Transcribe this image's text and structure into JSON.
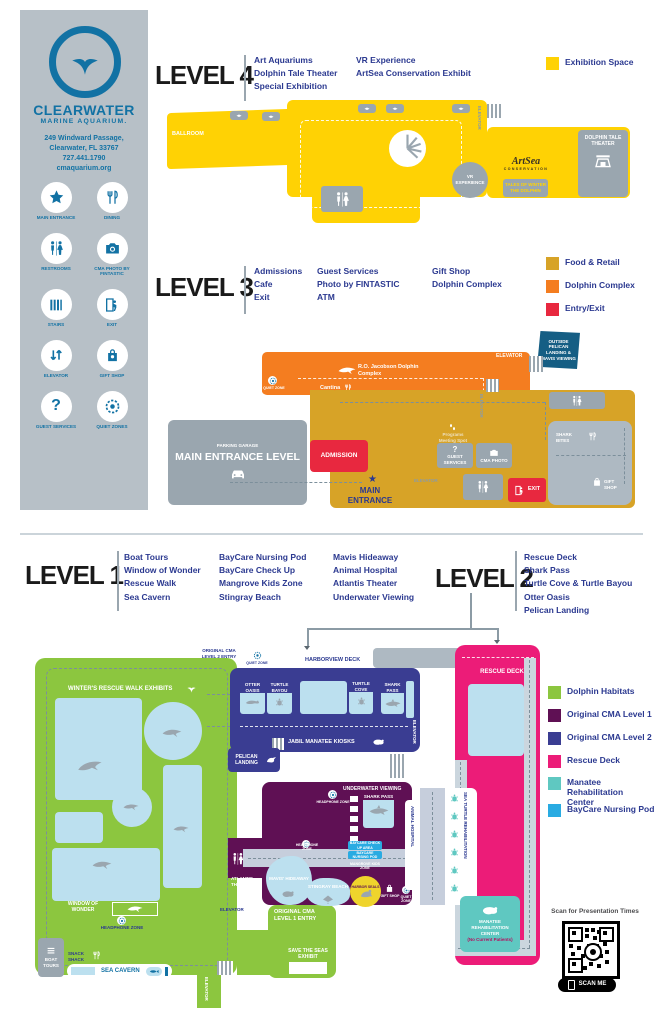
{
  "palette": {
    "sidebar_gray": "#B7C0C7",
    "cma_blue": "#1272A4",
    "navy_text": "#2B3990",
    "yellow": "#FFD204",
    "gold": "#D7A327",
    "orange": "#F47D20",
    "red": "#E8283F",
    "flag_navy": "#155E84",
    "gray_box": "#9AA6AF",
    "green": "#8CC63F",
    "level1_purple": "#5F1054",
    "level2_navy": "#3A3D92",
    "pink": "#EC1C78",
    "teal": "#5FC8C1",
    "baycare_blue": "#29ABE2",
    "pool_blue": "#BCE0EF",
    "seal_yellow": "#EFD42C"
  },
  "sidebar": {
    "org_name": "CLEARWATER",
    "org_sub": "MARINE AQUARIUM.",
    "address_line1": "249 Windward Passage,",
    "address_line2": "Clearwater, FL 33767",
    "address_line3": "727.441.1790",
    "address_line4": "cmaquarium.org",
    "icons": [
      {
        "label": "MAIN ENTRANCE"
      },
      {
        "label": "DINING"
      },
      {
        "label": "RESTROOMS"
      },
      {
        "label": "CMA PHOTO by FINTASTIC"
      },
      {
        "label": "STAIRS"
      },
      {
        "label": "EXIT"
      },
      {
        "label": "ELEVATOR"
      },
      {
        "label": "GIFT SHOP"
      },
      {
        "label": "GUEST SERVICES"
      },
      {
        "label": "QUIET ZONES"
      }
    ]
  },
  "level4": {
    "title": "LEVEL 4",
    "features_col1": [
      "Art Aquariums",
      "Dolphin Tale Theater",
      "Special Exhibition"
    ],
    "features_col2": [
      "VR Experience",
      "ArtSea Conservation Exhibit"
    ],
    "legend": [
      {
        "label": "Exhibition Space",
        "color": "#FFD204"
      }
    ],
    "map": {
      "ballroom": "BALLROOM",
      "elevator": "ELEVATOR",
      "vr_circle": "VR EXPERIENCE",
      "artsea_name": "ArtSea",
      "artsea_sub": "CONSERVATION",
      "tales": "TALES OF WINTER THE DOLPHIN",
      "theater": "DOLPHIN TALE THEATER"
    }
  },
  "level3": {
    "title": "LEVEL 3",
    "features_col1": [
      "Admissions",
      "Cafe",
      "Exit"
    ],
    "features_col2": [
      "Guest Services",
      "Photo by FINTASTIC",
      "ATM"
    ],
    "features_col3": [
      "Gift Shop",
      "Dolphin Complex"
    ],
    "legend": [
      {
        "label": "Food & Retail",
        "color": "#D7A327"
      },
      {
        "label": "Dolphin Complex",
        "color": "#F47D20"
      },
      {
        "label": "Entry/Exit",
        "color": "#E8283F"
      }
    ],
    "map": {
      "flag": "OUTSIDE PELICAN LANDING & MAVIS VIEWING",
      "elevator_top": "ELEVATOR",
      "dolphin_complex": "R.O. Jacobson Dolphin Complex",
      "cantina": "Cantina",
      "quiet_zone": "QUIET ZONE",
      "parking_top": "PARKING GARAGE",
      "parking_main": "MAIN ENTRANCE LEVEL",
      "admission": "ADMISSION",
      "programs": "Programs Meeting Spot",
      "guest_services": "GUEST SERVICES",
      "cma_photo": "CMA PHOTO",
      "elevator_mid": "ELEVATOR",
      "elevator_low": "ELEVATOR",
      "main_entrance": "MAIN ENTRANCE",
      "shark_bites": "SHARK BITES",
      "exit": "EXIT",
      "gift_shop": "GIFT SHOP"
    }
  },
  "level1": {
    "title": "LEVEL 1",
    "features_col1": [
      "Boat Tours",
      "Window of Wonder",
      "Rescue Walk",
      "Sea Cavern"
    ],
    "features_col2": [
      "BayCare Nursing Pod",
      "BayCare Check Up",
      "Mangrove Kids Zone",
      "Stingray Beach"
    ],
    "features_col3": [
      "Mavis Hideaway",
      "Animal Hospital",
      "Atlantis Theater",
      "Underwater Viewing"
    ]
  },
  "level2": {
    "title": "LEVEL 2",
    "features": [
      "Rescue Deck",
      "Shark Pass",
      "Turtle Cove & Turtle Bayou",
      "Otter Oasis",
      "Pelican Landing"
    ]
  },
  "lower_map": {
    "original_cma_level2_entry": "ORIGINAL CMA LEVEL 2 ENTRY",
    "quiet_zone_top": "QUIET ZONE",
    "harborview_deck": "HARBORVIEW DECK",
    "winters_rescue": "WINTER'S RESCUE WALK EXHIBITS",
    "otter_oasis": "OTTER OASIS",
    "turtle_bayou": "TURTLE BAYOU",
    "turtle_cove": "TURTLE COVE",
    "shark_pass_l2": "SHARK PASS",
    "rescue_deck": "RESCUE DECK",
    "jabil": "JABIL MANATEE KIOSKS",
    "pelican_landing": "PELICAN LANDING",
    "elevator": "ELEVATOR",
    "underwater_viewing": "UNDERWATER VIEWING",
    "shark_pass_l1": "SHARK PASS",
    "headphone_zone": "HEADPHONE ZONE",
    "animal_hospital": "ANIMAL HOSPITAL",
    "sea_turtle_rehab": "SEA TURTLE REHABILITATION",
    "baycare_checkup": "BAYCARE CHECK UP AREA",
    "baycare_nursing": "BAYCARE NURSING POD",
    "mangrove": "MANGROVE KIDS ZONE",
    "mavis": "MAVIS' HIDEAWAY",
    "stingray": "STINGRAY BEACH",
    "harbor_seals": "HARBOR SEALS",
    "gift_shop": "GIFT SHOP",
    "quiet_zone_south": "QUIET ZONE",
    "atlantis": "ATLANTIS THEATER",
    "window_of_wonder": "WINDOW OF WONDER",
    "boat_tours": "BOAT TOURS",
    "snack_shack": "SNACK SHACK",
    "sea_cavern": "SEA CAVERN",
    "original_cma_level1_entry": "ORIGINAL CMA LEVEL 1 ENTRY",
    "save_the_seas": "SAVE THE SEAS EXHIBIT",
    "manatee_rehab": "MANATEE REHABILITATION CENTER",
    "manatee_note": "(No Current Patients)"
  },
  "lower_legend": [
    {
      "label": "Dolphin Habitats",
      "color": "#8CC63F"
    },
    {
      "label": "Original CMA Level 1",
      "color": "#5F1054"
    },
    {
      "label": "Original CMA Level 2",
      "color": "#3A3D92"
    },
    {
      "label": "Rescue Deck",
      "color": "#EC1C78"
    },
    {
      "label": "Manatee Rehabilitation Center",
      "color": "#5FC8C1"
    },
    {
      "label": "BayCare Nursing Pod",
      "color": "#29ABE2"
    }
  ],
  "qr": {
    "caption": "Scan for Presentation Times",
    "button": "SCAN ME"
  }
}
